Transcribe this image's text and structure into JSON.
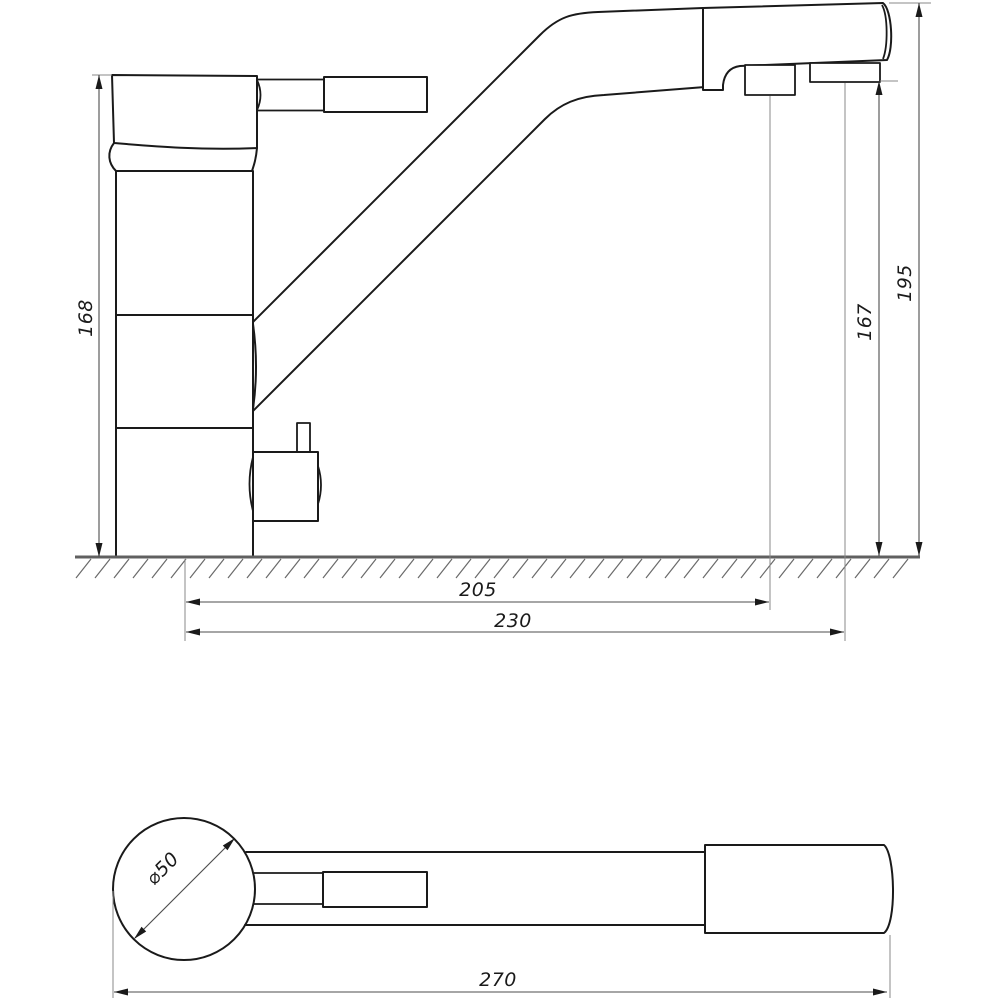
{
  "drawing": {
    "kind": "technical-dimension-drawing",
    "subject": "kitchen mixer faucet, side elevation and plan view",
    "background_color": "#ffffff",
    "line_color": "#1a1a1a",
    "dimension_line_color": "#4d4d4d",
    "ground_line_color": "#606060"
  },
  "dimensions": {
    "side_view": {
      "body_height": "168",
      "spout_outlet_height": "167",
      "total_height": "195",
      "aerator_reach": "205",
      "filter_spout_reach": "230"
    },
    "top_view": {
      "total_length": "270",
      "base_diameter": "⌀50"
    }
  }
}
